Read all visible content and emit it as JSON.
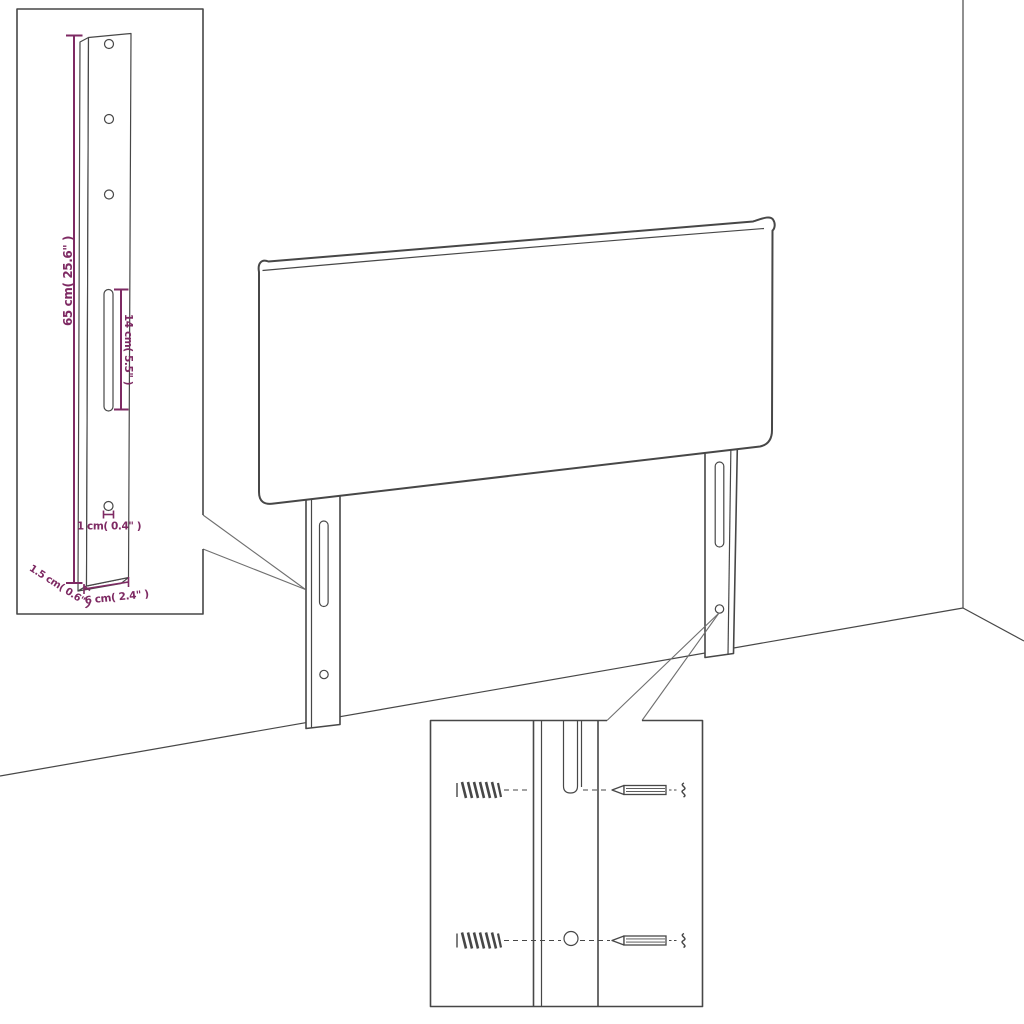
{
  "title": "Headboard with legs - assembly dimension diagram",
  "colors": {
    "background": "#ffffff",
    "line": "#474747",
    "dimension": "#7e2a63"
  },
  "dimensions": {
    "leg_height": "65 cm( 25.6\" )",
    "slot_length": "14 cm( 5.5\" )",
    "hole_diameter": "1 cm( 0.4\" )",
    "leg_thickness": "1.5 cm( 0.6\" )",
    "leg_width": "6 cm( 2.4\" )"
  }
}
